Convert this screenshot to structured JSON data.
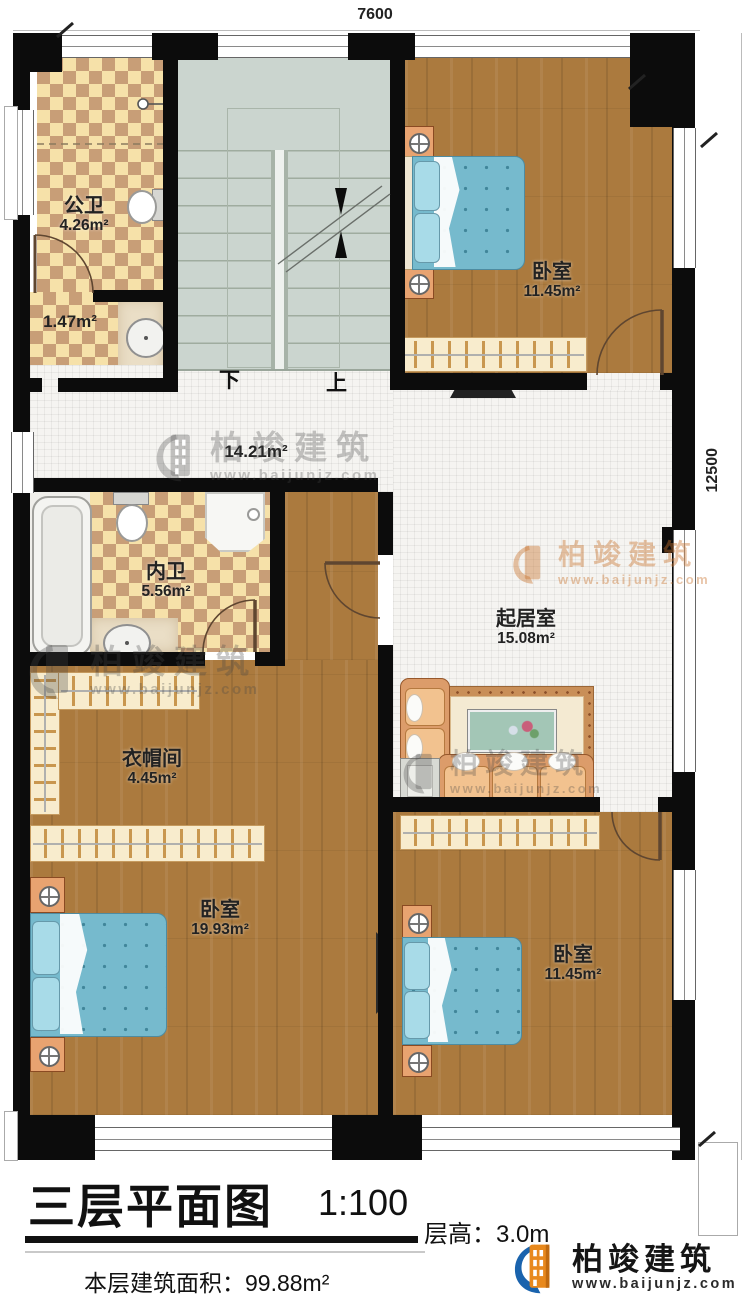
{
  "plan": {
    "dim_width": "7600",
    "dim_height": "12500",
    "stair_down": "下",
    "stair_up": "上"
  },
  "rooms": {
    "gongwei": {
      "name": "公卫",
      "area": "4.26m²"
    },
    "ante": {
      "area": "1.47m²"
    },
    "bedroom_tr": {
      "name": "卧室",
      "area": "11.45m²"
    },
    "hall": {
      "area": "14.21m²"
    },
    "neiwei": {
      "name": "内卫",
      "area": "5.56m²"
    },
    "living": {
      "name": "起居室",
      "area": "15.08m²"
    },
    "cloakroom": {
      "name": "衣帽间",
      "area": "4.45m²"
    },
    "bedroom_bl": {
      "name": "卧室",
      "area": "19.93m²"
    },
    "bedroom_br": {
      "name": "卧室",
      "area": "11.45m²"
    }
  },
  "titleblock": {
    "title": "三层平面图",
    "scale": "1:100",
    "floor_height": "层高：3.0m",
    "floor_area": "本层建筑面积：99.88m²"
  },
  "brand": {
    "name": "柏竣建筑",
    "url": "www.baijunjz.com"
  },
  "colors": {
    "wall": "#0c0c0c",
    "wood_floor": "#ab7a3e",
    "tile_cream": "#f6e1a9",
    "tile_tan": "#c89e77",
    "stair": "#cbd5cf",
    "bed_blue": "#76bacd",
    "logo_blue": "#1a63ad",
    "logo_orange": "#e8891d"
  }
}
